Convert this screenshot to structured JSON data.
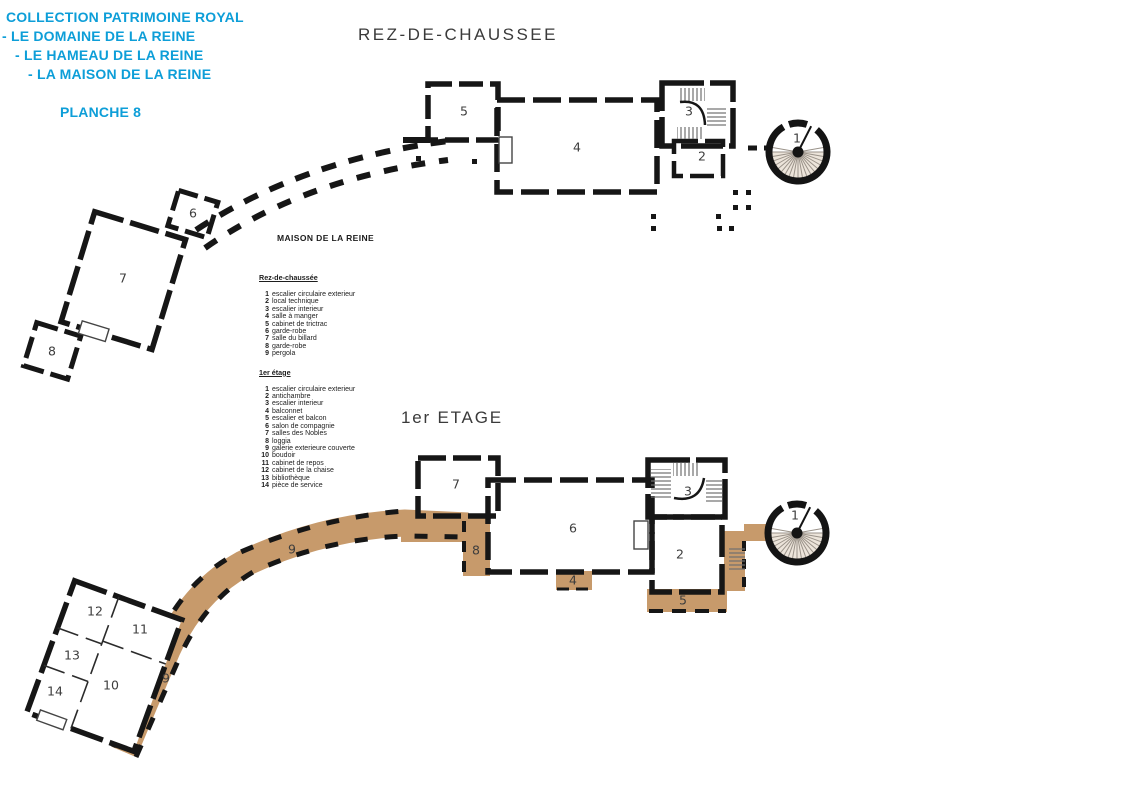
{
  "header": {
    "line1": "COLLECTION PATRIMOINE ROYAL",
    "line2": "- LE DOMAINE DE LA REINE",
    "line3": "- LE HAMEAU DE LA REINE",
    "line4": "- LA MAISON DE LA REINE",
    "planche": "PLANCHE 8"
  },
  "colors": {
    "accent_cyan": "#0d9ed8",
    "gallery_tan": "#c79a6b",
    "ink": "#161616"
  },
  "plans": {
    "ground": {
      "title": "REZ-DE-CHAUSSEE",
      "building_label": "MAISON DE LA REINE",
      "labels": [
        {
          "label": "1",
          "x": 797,
          "y": 139
        },
        {
          "label": "2",
          "x": 702,
          "y": 157
        },
        {
          "label": "3",
          "x": 689,
          "y": 112
        },
        {
          "label": "4",
          "x": 577,
          "y": 148
        },
        {
          "label": "5",
          "x": 464,
          "y": 112
        },
        {
          "label": "6",
          "x": 193,
          "y": 214
        },
        {
          "label": "7",
          "x": 123,
          "y": 279
        },
        {
          "label": "8",
          "x": 52,
          "y": 352
        }
      ]
    },
    "first": {
      "title": "1er ETAGE",
      "labels": [
        {
          "label": "1",
          "x": 795,
          "y": 516
        },
        {
          "label": "2",
          "x": 680,
          "y": 555
        },
        {
          "label": "3",
          "x": 688,
          "y": 492
        },
        {
          "label": "4",
          "x": 573,
          "y": 581
        },
        {
          "label": "5",
          "x": 683,
          "y": 601
        },
        {
          "label": "6",
          "x": 573,
          "y": 529
        },
        {
          "label": "7",
          "x": 456,
          "y": 485
        },
        {
          "label": "8",
          "x": 476,
          "y": 551
        },
        {
          "label": "9",
          "x": 292,
          "y": 550
        },
        {
          "label": "9",
          "x": 166,
          "y": 679
        },
        {
          "label": "10",
          "x": 111,
          "y": 686
        },
        {
          "label": "11",
          "x": 140,
          "y": 630
        },
        {
          "label": "12",
          "x": 95,
          "y": 612
        },
        {
          "label": "13",
          "x": 72,
          "y": 656
        },
        {
          "label": "14",
          "x": 55,
          "y": 692
        }
      ]
    }
  },
  "legend": {
    "sections": [
      {
        "heading": "Rez-de-chaussée",
        "items": [
          {
            "num": "1",
            "label": "escalier circulaire exterieur"
          },
          {
            "num": "2",
            "label": "local technique"
          },
          {
            "num": "3",
            "label": "escalier interieur"
          },
          {
            "num": "4",
            "label": "salle à manger"
          },
          {
            "num": "5",
            "label": "cabinet de trictrac"
          },
          {
            "num": "6",
            "label": "garde-robe"
          },
          {
            "num": "7",
            "label": "salle du billard"
          },
          {
            "num": "8",
            "label": "garde-robe"
          },
          {
            "num": "9",
            "label": "pergola"
          }
        ]
      },
      {
        "heading": "1er étage",
        "items": [
          {
            "num": "1",
            "label": "escalier circulaire exterieur"
          },
          {
            "num": "2",
            "label": "antichambre"
          },
          {
            "num": "3",
            "label": "escalier interieur"
          },
          {
            "num": "4",
            "label": "balconnet"
          },
          {
            "num": "5",
            "label": "escalier et balcon"
          },
          {
            "num": "6",
            "label": "salon de compagnie"
          },
          {
            "num": "7",
            "label": "salles des Nobles"
          },
          {
            "num": "8",
            "label": "loggia"
          },
          {
            "num": "9",
            "label": "galerie exterieure couverte"
          },
          {
            "num": "10",
            "label": "boudoir"
          },
          {
            "num": "11",
            "label": "cabinet de repos"
          },
          {
            "num": "12",
            "label": "cabinet de la chaise"
          },
          {
            "num": "13",
            "label": "bibliothèque"
          },
          {
            "num": "14",
            "label": "pièce de service"
          }
        ]
      }
    ]
  }
}
